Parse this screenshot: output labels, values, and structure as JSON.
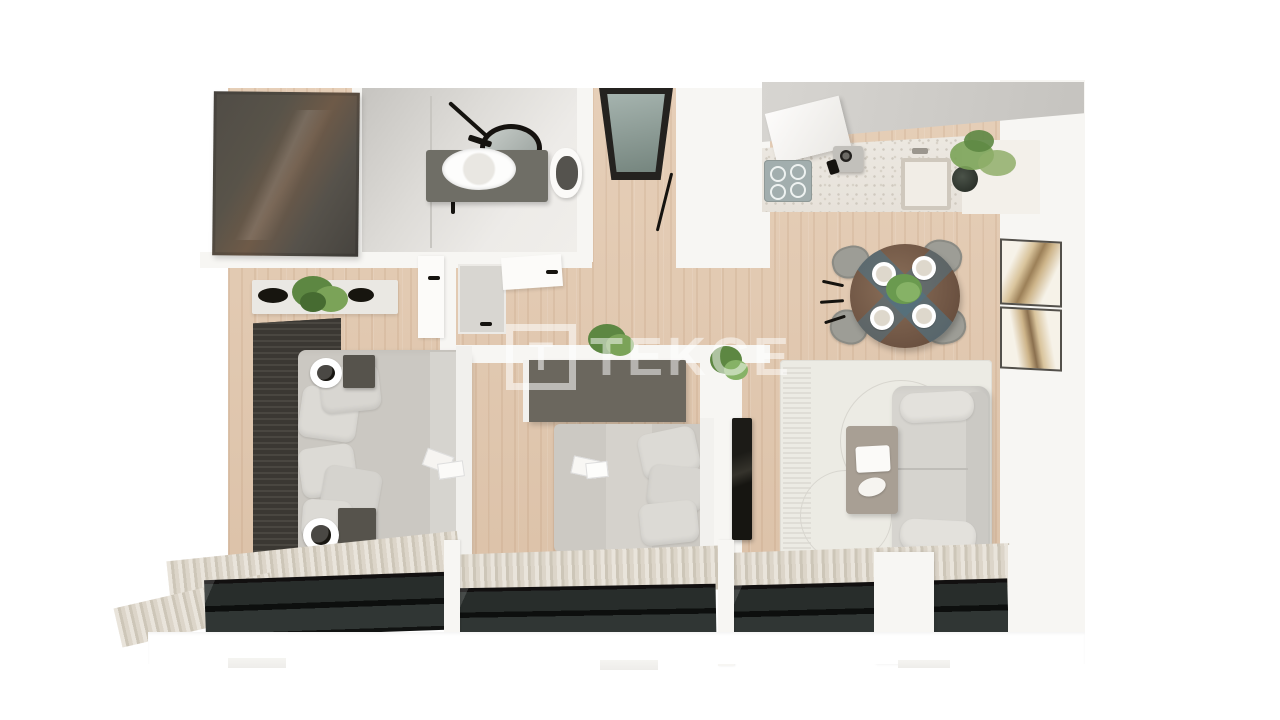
{
  "watermark": {
    "logo_letter": "T",
    "brand": "TEKCE"
  },
  "colors": {
    "background": "#ffffff",
    "wall_white": "#f7f6f3",
    "wood_floor": "#e0c7af",
    "closet_wardrobe": "#54504a",
    "bedroom2_wardrobe": "#6b675e",
    "accent_slat_wall": "#38352f",
    "bathroom_wall": "#d6d4d0",
    "entry_door_glass": "#8da19b",
    "sofa": "#d7d5d0",
    "rug": "#ecebe4",
    "coffee_table": "#a89f94",
    "dining_table_wood": "#7b6150",
    "dining_runner_teal": "#4f7283",
    "balcony_glass": "#232726",
    "curtain_stripe": "#dcd5c9",
    "plant_green": "#6a9a4f",
    "bedding_gray": "#cccac4",
    "cooktop": "#a2aeae",
    "tv_panel": "#161511"
  }
}
